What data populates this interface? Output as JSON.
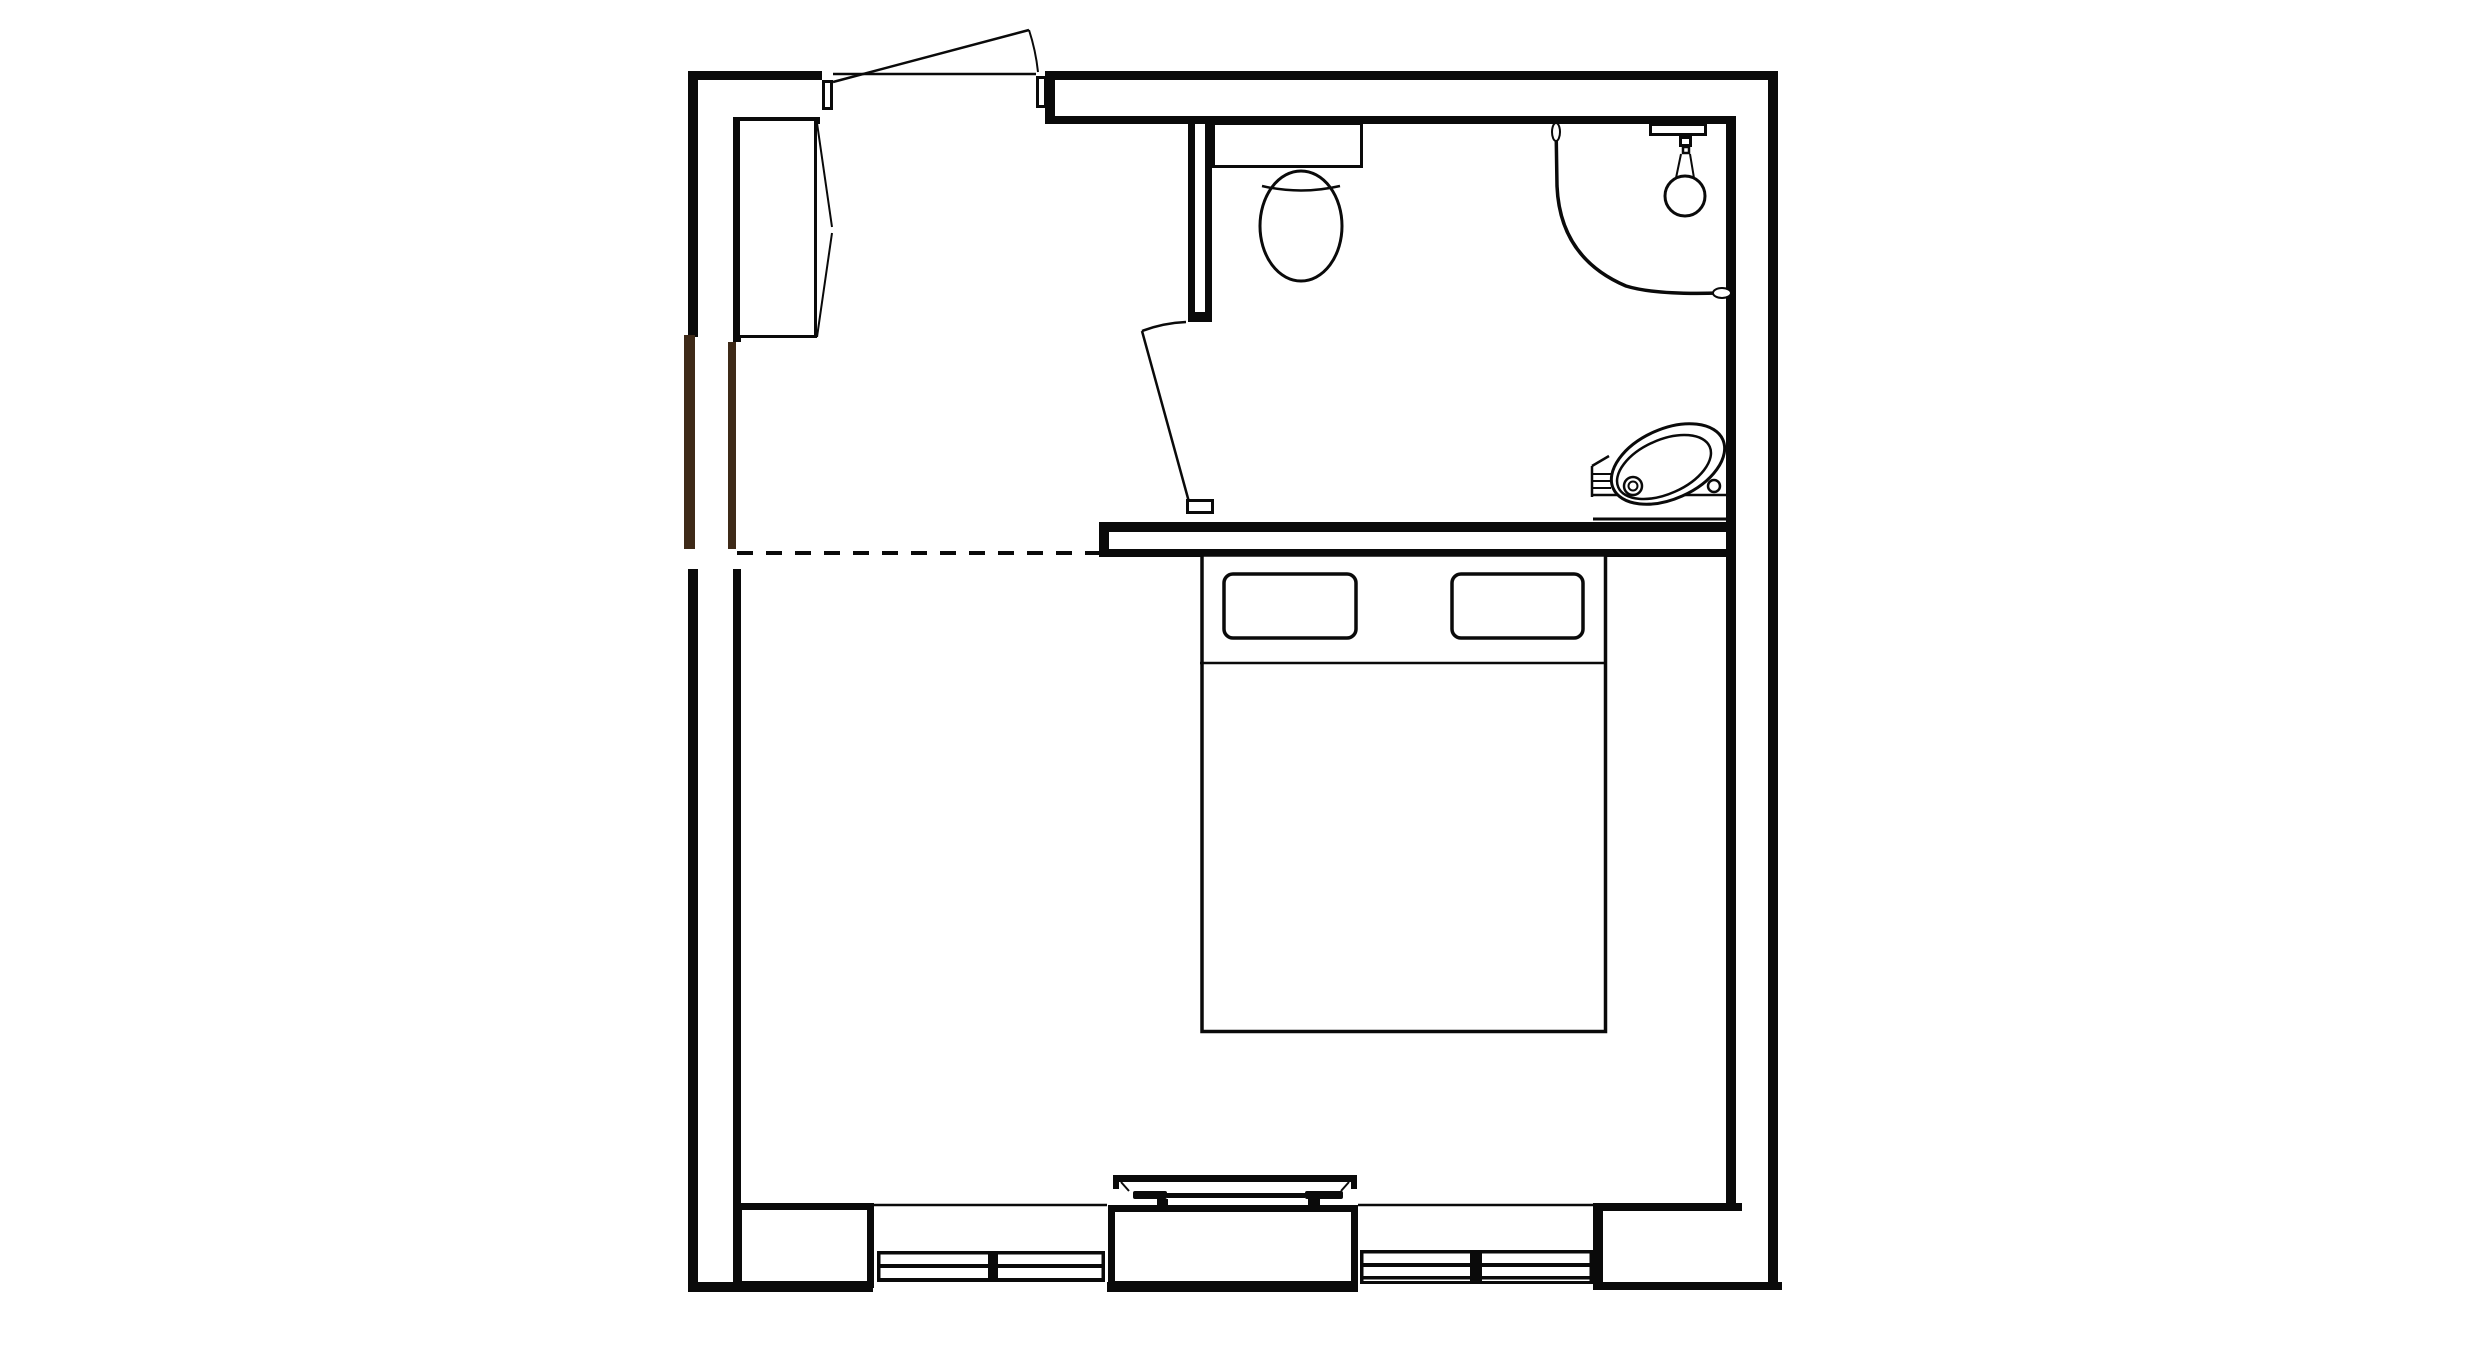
{
  "plan": {
    "description": "architectural-floor-plan",
    "colors": {
      "ink": "#0a0a0a",
      "wood": "#3e2a18",
      "paper": "#ffffff"
    },
    "canvas": {
      "width": 2480,
      "height": 1365
    },
    "elements": [
      {
        "name": "wall-top-outer-left",
        "type": "rect",
        "x": 688,
        "y": 71,
        "w": 134,
        "h": 9,
        "fill": "ink"
      },
      {
        "name": "wall-top-outer-right",
        "type": "rect",
        "x": 1045,
        "y": 71,
        "w": 733,
        "h": 9,
        "fill": "ink"
      },
      {
        "name": "wall-top-inner-left",
        "type": "rect",
        "x": 733,
        "y": 117,
        "w": 87,
        "h": 7,
        "fill": "ink"
      },
      {
        "name": "wall-top-inner-right",
        "type": "rect",
        "x": 1045,
        "y": 116,
        "w": 691,
        "h": 8,
        "fill": "ink"
      },
      {
        "name": "wall-top-right-end-cap",
        "type": "rect",
        "x": 1045,
        "y": 71,
        "w": 10,
        "h": 53,
        "fill": "ink"
      },
      {
        "name": "wall-left-outer-upper",
        "type": "rect",
        "x": 688,
        "y": 71,
        "w": 10,
        "h": 266,
        "fill": "ink"
      },
      {
        "name": "wall-left-outer-wood",
        "type": "rect",
        "x": 684,
        "y": 335,
        "w": 11,
        "h": 214,
        "fill": "wood"
      },
      {
        "name": "wall-left-outer-lower",
        "type": "rect",
        "x": 688,
        "y": 569,
        "w": 10,
        "h": 723,
        "fill": "ink"
      },
      {
        "name": "wall-left-inner-upper",
        "type": "rect",
        "x": 733,
        "y": 117,
        "w": 8,
        "h": 225,
        "fill": "ink"
      },
      {
        "name": "wall-left-inner-wood",
        "type": "rect",
        "x": 728,
        "y": 342,
        "w": 8,
        "h": 207,
        "fill": "wood"
      },
      {
        "name": "wall-left-inner-lower",
        "type": "rect",
        "x": 733,
        "y": 569,
        "w": 8,
        "h": 719,
        "fill": "ink"
      },
      {
        "name": "wall-right-outer",
        "type": "rect",
        "x": 1768,
        "y": 71,
        "w": 10,
        "h": 1219,
        "fill": "ink"
      },
      {
        "name": "wall-right-inner",
        "type": "rect",
        "x": 1726,
        "y": 116,
        "w": 10,
        "h": 1089,
        "fill": "ink"
      },
      {
        "name": "wall-bottom-band-left",
        "type": "rect",
        "x": 688,
        "y": 1282,
        "w": 185,
        "h": 10,
        "fill": "ink"
      },
      {
        "name": "wall-bottom-band-middle",
        "type": "rect",
        "x": 1107,
        "y": 1282,
        "w": 251,
        "h": 10,
        "fill": "ink"
      },
      {
        "name": "wall-bottom-band-right",
        "type": "rect",
        "x": 1593,
        "y": 1282,
        "w": 189,
        "h": 8,
        "fill": "ink"
      },
      {
        "name": "wall-bottom-corner-top-edge",
        "type": "rect",
        "x": 1593,
        "y": 1203,
        "w": 149,
        "h": 8,
        "fill": "ink"
      },
      {
        "name": "wall-bottom-corner-left-edge",
        "type": "rect",
        "x": 1593,
        "y": 1205,
        "w": 10,
        "h": 85,
        "fill": "ink"
      },
      {
        "name": "window-sill-line-left",
        "type": "line",
        "x1": 874,
        "y1": 1205,
        "x2": 1107,
        "y2": 1205,
        "sw": 2.5
      },
      {
        "name": "window-sill-line-right",
        "type": "line",
        "x1": 1358,
        "y1": 1205,
        "x2": 1593,
        "y2": 1205,
        "sw": 2.5
      },
      {
        "name": "bathroom-wall-top-line",
        "type": "rect",
        "x": 1099,
        "y": 522,
        "w": 637,
        "h": 10,
        "fill": "ink"
      },
      {
        "name": "bathroom-wall-bottom-line",
        "type": "rect",
        "x": 1099,
        "y": 549,
        "w": 637,
        "h": 8,
        "fill": "ink"
      },
      {
        "name": "bathroom-wall-end-cap",
        "type": "rect",
        "x": 1099,
        "y": 522,
        "w": 10,
        "h": 35,
        "fill": "ink"
      },
      {
        "name": "bathroom-partition-west-line",
        "type": "rect",
        "x": 1188,
        "y": 122,
        "w": 7,
        "h": 190,
        "fill": "ink"
      },
      {
        "name": "bathroom-partition-east-line",
        "type": "rect",
        "x": 1205,
        "y": 122,
        "w": 7,
        "h": 190,
        "fill": "ink"
      },
      {
        "name": "bathroom-partition-cap",
        "type": "rect",
        "x": 1188,
        "y": 312,
        "w": 24,
        "h": 10,
        "fill": "ink"
      },
      {
        "name": "entry-boundary-dashed-line",
        "type": "line",
        "x1": 737,
        "y1": 553,
        "x2": 1099,
        "y2": 553,
        "sw": 4,
        "dash": "16 13"
      },
      {
        "name": "bottom-wall-pier-left",
        "type": "rect",
        "x": 738.5,
        "y": 1206.5,
        "w": 132,
        "h": 78,
        "fill": "paper",
        "stroke": "ink",
        "sw": 7
      },
      {
        "name": "bottom-wall-pier-center",
        "type": "rect",
        "x": 1111.5,
        "y": 1208.5,
        "w": 243,
        "h": 76,
        "fill": "paper",
        "stroke": "ink",
        "sw": 7
      },
      {
        "name": "window-left-frame-top",
        "type": "rect",
        "x": 877,
        "y": 1251,
        "w": 228,
        "h": 3.5,
        "fill": "ink"
      },
      {
        "name": "window-left-frame-middle",
        "type": "rect",
        "x": 877,
        "y": 1264,
        "w": 228,
        "h": 4,
        "fill": "ink"
      },
      {
        "name": "window-left-frame-bottom",
        "type": "rect",
        "x": 877,
        "y": 1278,
        "w": 228,
        "h": 4,
        "fill": "ink"
      },
      {
        "name": "window-left-cap-left",
        "type": "rect",
        "x": 877,
        "y": 1251,
        "w": 3.5,
        "h": 31,
        "fill": "ink"
      },
      {
        "name": "window-left-cap-right",
        "type": "rect",
        "x": 1101.5,
        "y": 1251,
        "w": 3.5,
        "h": 31,
        "fill": "ink"
      },
      {
        "name": "window-left-mullion",
        "type": "rect",
        "x": 988,
        "y": 1251,
        "w": 10,
        "h": 31,
        "fill": "ink"
      },
      {
        "name": "window-right-frame-top",
        "type": "rect",
        "x": 1360,
        "y": 1250,
        "w": 233,
        "h": 3.5,
        "fill": "ink"
      },
      {
        "name": "window-right-frame-middle",
        "type": "rect",
        "x": 1360,
        "y": 1263,
        "w": 233,
        "h": 4,
        "fill": "ink"
      },
      {
        "name": "window-right-frame-bottom",
        "type": "rect",
        "x": 1360,
        "y": 1276,
        "w": 233,
        "h": 3.5,
        "fill": "ink"
      },
      {
        "name": "window-right-frame-outer",
        "type": "rect",
        "x": 1360,
        "y": 1281,
        "w": 233,
        "h": 3,
        "fill": "ink"
      },
      {
        "name": "window-right-cap-left",
        "type": "rect",
        "x": 1360,
        "y": 1250,
        "w": 3.5,
        "h": 34,
        "fill": "ink"
      },
      {
        "name": "window-right-cap-right",
        "type": "rect",
        "x": 1589.5,
        "y": 1250,
        "w": 3.5,
        "h": 34,
        "fill": "ink"
      },
      {
        "name": "window-right-mullion",
        "type": "rect",
        "x": 1470,
        "y": 1250,
        "w": 12,
        "h": 34,
        "fill": "ink"
      },
      {
        "name": "entry-door-jamb-left",
        "type": "rect",
        "x": 823.5,
        "y": 81.5,
        "w": 8,
        "h": 27,
        "fill": "paper",
        "stroke": "ink",
        "sw": 3
      },
      {
        "name": "entry-door-jamb-right",
        "type": "rect",
        "x": 1037.5,
        "y": 77.5,
        "w": 8,
        "h": 29,
        "fill": "paper",
        "stroke": "ink",
        "sw": 3
      },
      {
        "name": "entry-door-threshold-line",
        "type": "line",
        "x1": 833,
        "y1": 74,
        "x2": 1036,
        "y2": 74,
        "sw": 2.5
      },
      {
        "name": "entry-door-leaf",
        "type": "line",
        "x1": 833,
        "y1": 82,
        "x2": 1029,
        "y2": 30,
        "sw": 2.5
      },
      {
        "name": "entry-door-swing-arc",
        "type": "path",
        "d": "M 1029 30 A 202 202 0 0 1 1038 72",
        "sw": 2
      },
      {
        "name": "closet-body",
        "type": "rect",
        "x": 738.5,
        "y": 119.5,
        "w": 77,
        "h": 217,
        "fill": "paper",
        "stroke": "ink",
        "sw": 3
      },
      {
        "name": "closet-door-upper-line",
        "type": "line",
        "x1": 817,
        "y1": 123,
        "x2": 832,
        "y2": 227,
        "sw": 2
      },
      {
        "name": "closet-door-lower-line",
        "type": "line",
        "x1": 832,
        "y1": 233,
        "x2": 817,
        "y2": 337,
        "sw": 2
      },
      {
        "name": "bathroom-door-jamb",
        "type": "rect",
        "x": 1187.5,
        "y": 500.5,
        "w": 25,
        "h": 12,
        "fill": "paper",
        "stroke": "ink",
        "sw": 3
      },
      {
        "name": "bathroom-door-top-edge",
        "type": "path",
        "d": "M 1186 322 Q 1163 323 1142 331",
        "sw": 2.5
      },
      {
        "name": "bathroom-door-leaf",
        "type": "line",
        "x1": 1142,
        "y1": 331,
        "x2": 1189,
        "y2": 502,
        "sw": 2.5
      },
      {
        "name": "toilet-tank",
        "type": "rect",
        "x": 1213.5,
        "y": 123.5,
        "w": 148,
        "h": 43,
        "fill": "paper",
        "stroke": "ink",
        "sw": 3
      },
      {
        "name": "toilet-bowl",
        "type": "ellipse",
        "cx": 1301,
        "cy": 226,
        "rx": 41,
        "ry": 55,
        "fill": "paper",
        "stroke": "ink",
        "sw": 3
      },
      {
        "name": "toilet-seat-line",
        "type": "path",
        "d": "M 1262 186 Q 1301 195 1340 186",
        "sw": 2.5
      },
      {
        "name": "shower-curtain-rod",
        "type": "path",
        "d": "M 1556 123 L 1557 186 Q 1560 258 1626 286 Q 1655 295 1719 293",
        "sw": 3.5
      },
      {
        "name": "shower-rod-finial-top",
        "type": "ellipse",
        "cx": 1556,
        "cy": 132,
        "rx": 4,
        "ry": 9,
        "fill": "paper",
        "stroke": "ink",
        "sw": 2
      },
      {
        "name": "shower-rod-finial-right",
        "type": "ellipse",
        "cx": 1722,
        "cy": 293,
        "rx": 9,
        "ry": 5,
        "fill": "paper",
        "stroke": "ink",
        "sw": 2
      },
      {
        "name": "shower-bracket-tick-1",
        "type": "rect",
        "x": 1653,
        "y": 117,
        "w": 7,
        "h": 6,
        "fill": "ink"
      },
      {
        "name": "shower-bracket-tick-2",
        "type": "rect",
        "x": 1665,
        "y": 117,
        "w": 7,
        "h": 6,
        "fill": "ink"
      },
      {
        "name": "shower-bracket-tick-3",
        "type": "rect",
        "x": 1692,
        "y": 117,
        "w": 6,
        "h": 6,
        "fill": "ink"
      },
      {
        "name": "shower-bracket",
        "type": "rect",
        "x": 1650.5,
        "y": 124.5,
        "w": 55,
        "h": 10,
        "fill": "paper",
        "stroke": "ink",
        "sw": 3
      },
      {
        "name": "shower-arm-upper",
        "type": "rect",
        "x": 1680.5,
        "y": 137.5,
        "w": 10,
        "h": 8,
        "fill": "paper",
        "stroke": "ink",
        "sw": 3
      },
      {
        "name": "shower-arm-lower",
        "type": "rect",
        "x": 1683,
        "y": 147,
        "w": 6,
        "h": 6,
        "fill": "paper",
        "stroke": "ink",
        "sw": 2.5
      },
      {
        "name": "shower-neck-left-line",
        "type": "line",
        "x1": 1681,
        "y1": 154,
        "x2": 1676,
        "y2": 178,
        "sw": 2
      },
      {
        "name": "shower-neck-right-line",
        "type": "line",
        "x1": 1690,
        "y1": 154,
        "x2": 1694,
        "y2": 178,
        "sw": 2
      },
      {
        "name": "shower-head",
        "type": "circle",
        "cx": 1685,
        "cy": 196,
        "r": 20,
        "fill": "paper",
        "stroke": "ink",
        "sw": 3
      },
      {
        "name": "sink-counter-top-line",
        "type": "line",
        "x1": 1593,
        "y1": 495,
        "x2": 1728,
        "y2": 495,
        "sw": 2.5
      },
      {
        "name": "sink-counter-front-line",
        "type": "line",
        "x1": 1593,
        "y1": 519,
        "x2": 1728,
        "y2": 519,
        "sw": 3
      },
      {
        "name": "sink-ledge-left-edge",
        "type": "line",
        "x1": 1592,
        "y1": 466,
        "x2": 1592,
        "y2": 497,
        "sw": 2.5
      },
      {
        "name": "sink-ledge-bevel",
        "type": "line",
        "x1": 1592,
        "y1": 466,
        "x2": 1609,
        "y2": 456,
        "sw": 2.5
      },
      {
        "name": "sink-towel-bar-1",
        "type": "line",
        "x1": 1592,
        "y1": 474,
        "x2": 1611,
        "y2": 474,
        "sw": 2
      },
      {
        "name": "sink-towel-bar-2",
        "type": "line",
        "x1": 1592,
        "y1": 481,
        "x2": 1611,
        "y2": 481,
        "sw": 2
      },
      {
        "name": "sink-towel-bar-3",
        "type": "line",
        "x1": 1592,
        "y1": 488,
        "x2": 1611,
        "y2": 488,
        "sw": 2
      },
      {
        "name": "sink-basin-outer",
        "type": "ellipse",
        "cx": 1668,
        "cy": 464,
        "rx": 60,
        "ry": 35,
        "rot": -24,
        "fill": "paper",
        "stroke": "ink",
        "sw": 3
      },
      {
        "name": "sink-basin-inner",
        "type": "ellipse",
        "cx": 1664,
        "cy": 467,
        "rx": 50,
        "ry": 27,
        "rot": -24,
        "stroke": "ink",
        "sw": 2.5
      },
      {
        "name": "sink-drain-outer",
        "type": "circle",
        "cx": 1633,
        "cy": 486,
        "r": 9,
        "fill": "paper",
        "stroke": "ink",
        "sw": 2.5
      },
      {
        "name": "sink-drain-inner",
        "type": "circle",
        "cx": 1633,
        "cy": 486,
        "r": 4.5,
        "stroke": "ink",
        "sw": 2
      },
      {
        "name": "sink-faucet",
        "type": "circle",
        "cx": 1714,
        "cy": 486,
        "r": 6,
        "fill": "paper",
        "stroke": "ink",
        "sw": 2.5
      },
      {
        "name": "bed-frame",
        "type": "rect",
        "x": 1202,
        "y": 555,
        "w": 403.5,
        "h": 476.5,
        "fill": "paper",
        "stroke": "ink",
        "sw": 3.5
      },
      {
        "name": "bed-headboard-line",
        "type": "line",
        "x1": 1200,
        "y1": 663,
        "x2": 1607,
        "y2": 663,
        "sw": 2.5
      },
      {
        "name": "bed-pillow-left",
        "type": "rect",
        "x": 1224,
        "y": 574,
        "w": 132,
        "h": 64,
        "rx": 9,
        "fill": "paper",
        "stroke": "ink",
        "sw": 3.5
      },
      {
        "name": "bed-pillow-right",
        "type": "rect",
        "x": 1452,
        "y": 574,
        "w": 131,
        "h": 64,
        "rx": 9,
        "fill": "paper",
        "stroke": "ink",
        "sw": 3.5
      },
      {
        "name": "bench-top-bar",
        "type": "rect",
        "x": 1113,
        "y": 1175,
        "w": 244,
        "h": 7,
        "fill": "ink"
      },
      {
        "name": "bench-top-bar-end-left",
        "type": "rect",
        "x": 1113,
        "y": 1175,
        "w": 6,
        "h": 14,
        "fill": "ink"
      },
      {
        "name": "bench-top-bar-end-right",
        "type": "rect",
        "x": 1351,
        "y": 1175,
        "w": 6,
        "h": 14,
        "fill": "ink"
      },
      {
        "name": "bench-side-left-line",
        "type": "line",
        "x1": 1121,
        "y1": 1182,
        "x2": 1129,
        "y2": 1191,
        "sw": 2
      },
      {
        "name": "bench-side-right-line",
        "type": "line",
        "x1": 1349,
        "y1": 1182,
        "x2": 1341,
        "y2": 1191,
        "sw": 2
      },
      {
        "name": "bench-rail-left",
        "type": "rect",
        "x": 1133,
        "y": 1191,
        "w": 34,
        "h": 8,
        "rx": 2,
        "fill": "ink"
      },
      {
        "name": "bench-rail-right",
        "type": "rect",
        "x": 1305,
        "y": 1191,
        "w": 38,
        "h": 8,
        "rx": 2,
        "fill": "ink"
      },
      {
        "name": "bench-rail-center",
        "type": "rect",
        "x": 1167,
        "y": 1193,
        "w": 138,
        "h": 5,
        "fill": "ink"
      },
      {
        "name": "bench-foot-left",
        "type": "rect",
        "x": 1157,
        "y": 1199,
        "w": 11,
        "h": 7,
        "fill": "ink"
      },
      {
        "name": "bench-foot-right",
        "type": "rect",
        "x": 1308,
        "y": 1199,
        "w": 12,
        "h": 7,
        "fill": "ink"
      }
    ]
  }
}
